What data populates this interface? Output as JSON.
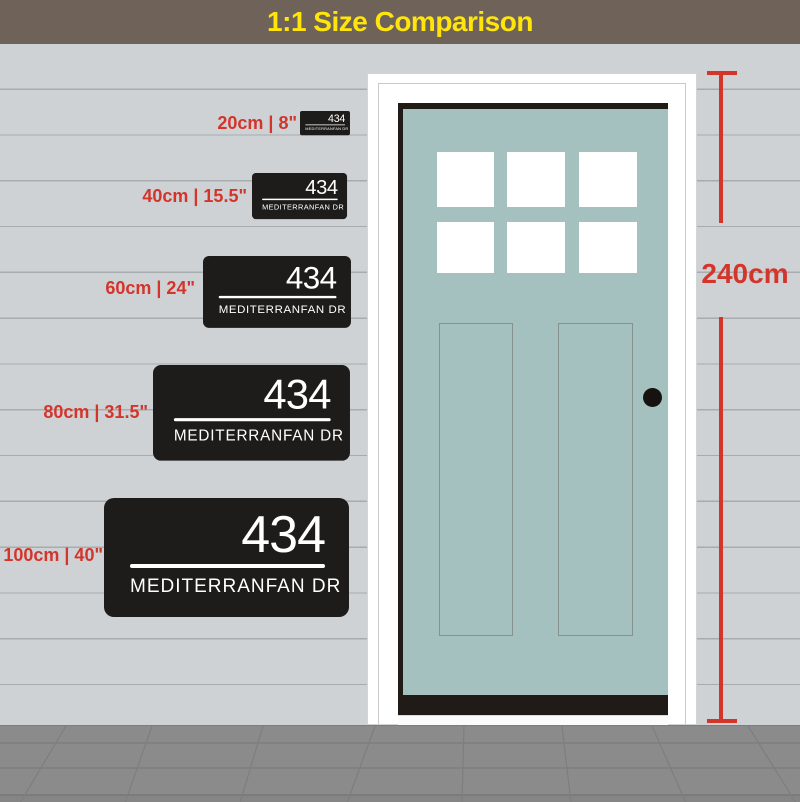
{
  "header": {
    "title": "1:1 Size Comparison"
  },
  "sign": {
    "number": "434",
    "street": "MEDITERRANFAN DR"
  },
  "sizes": [
    {
      "label": "20cm | 8\""
    },
    {
      "label": "40cm | 15.5\""
    },
    {
      "label": "60cm | 24\""
    },
    {
      "label": "80cm | 31.5\""
    },
    {
      "label": "100cm | 40\""
    }
  ],
  "measurement": {
    "label": "240cm"
  },
  "colors": {
    "header_bg": "#6f6359",
    "title_yellow": "#ffe50a",
    "accent_red": "#d4352b",
    "wall": "#ced2d5",
    "siding_line": "#a7acaf",
    "door_teal": "#a4c1c0",
    "sign_black": "#1e1c1a",
    "floor": "#8b8b8b"
  }
}
